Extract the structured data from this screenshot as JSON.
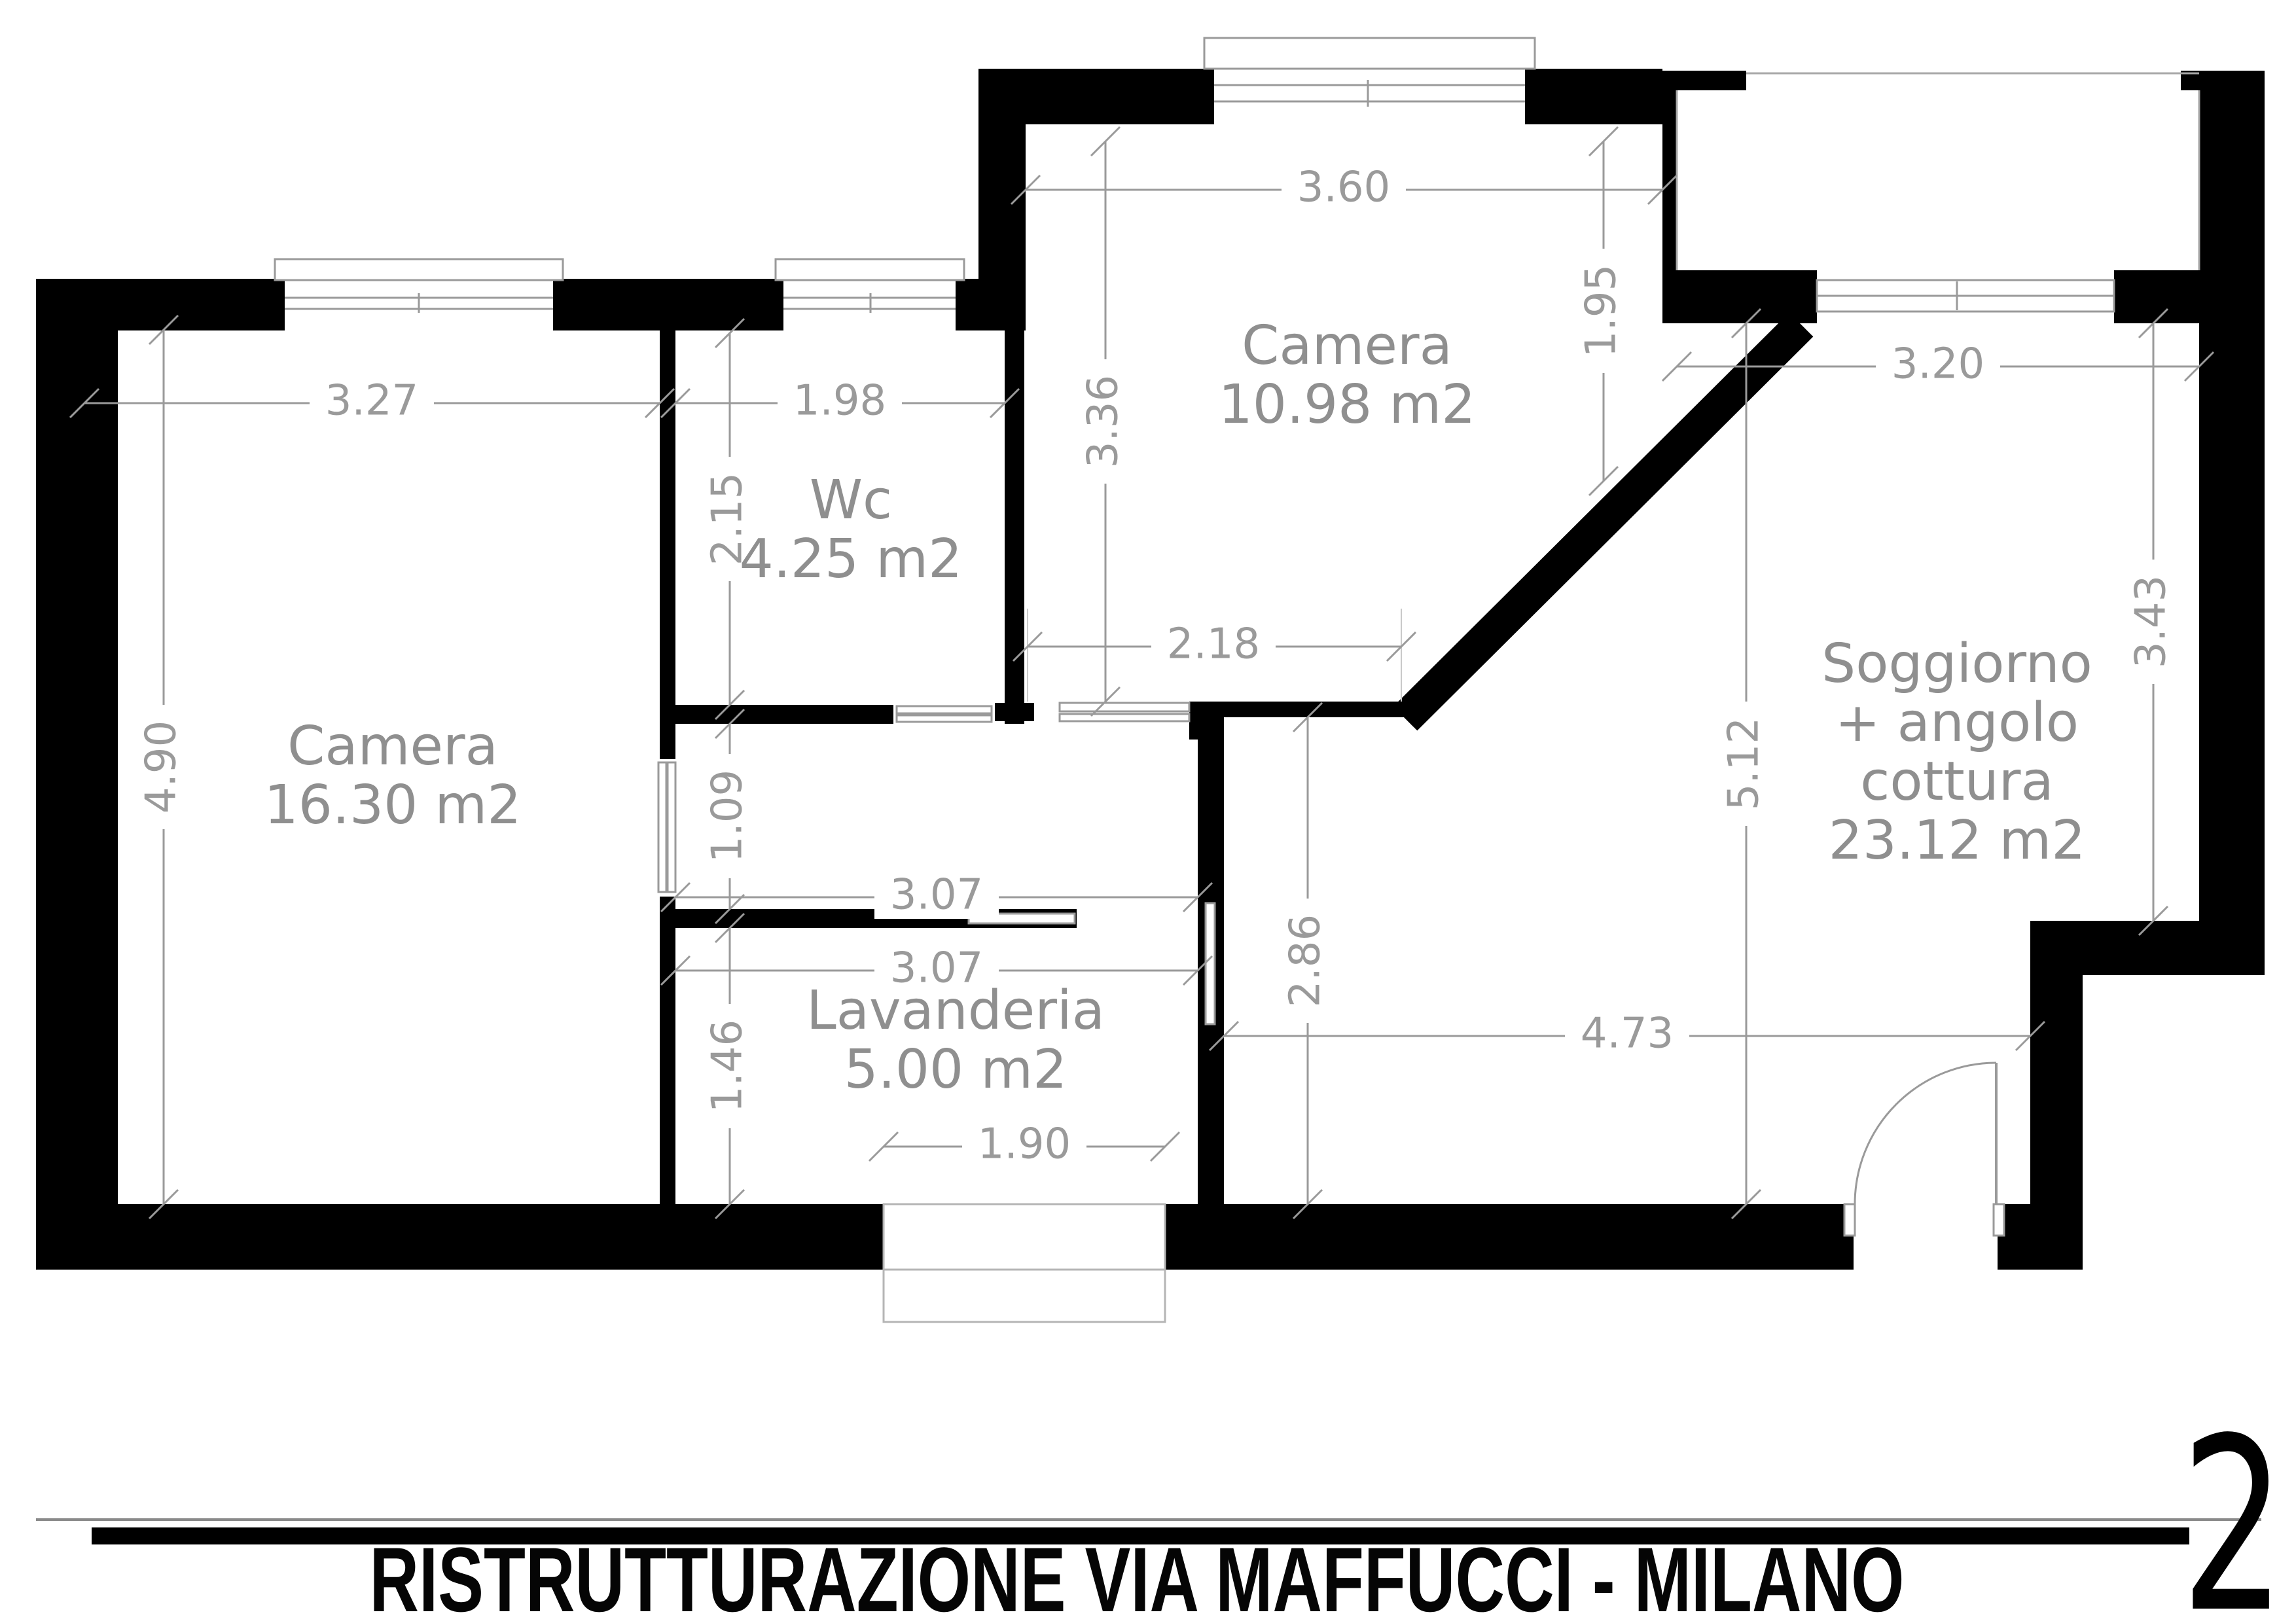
{
  "title_block": {
    "project_title": "RISTRUTTURAZIONE VIA MAFFUCCI - MILANO",
    "sheet_number": "2"
  },
  "floor_plan": {
    "rooms": [
      {
        "id": "camera-sx",
        "name": "Camera",
        "area": "16.30 m2"
      },
      {
        "id": "wc",
        "name": "Wc",
        "area": "4.25 m2"
      },
      {
        "id": "camera-top",
        "name": "Camera",
        "area": "10.98 m2"
      },
      {
        "id": "soggiorno",
        "name": "Soggiorno",
        "name_line2": "+ angolo",
        "name_line3": "cottura",
        "area": "23.12 m2"
      },
      {
        "id": "lavanderia",
        "name": "Lavanderia",
        "area": "5.00 m2"
      }
    ],
    "dimensions_m": {
      "camera_sx_width": "3.27",
      "camera_sx_height": "4.90",
      "wc_width": "1.98",
      "wc_height": "2.15",
      "camera_top_width": "3.60",
      "camera_top_height_left": "3.36",
      "camera_top_height_right": "1.95",
      "camera_top_lower_width": "2.18",
      "soggiorno_top_width": "3.20",
      "soggiorno_height_left": "5.12",
      "soggiorno_height_right": "3.43",
      "soggiorno_lower_width": "4.73",
      "soggiorno_passage_height": "2.86",
      "corridor_height": "1.09",
      "lavanderia_top_width": "3.07",
      "lavanderia_width": "3.07",
      "lavanderia_height": "1.46",
      "lavanderia_door_width": "1.90"
    },
    "colors": {
      "walls": "#000000",
      "dimension_lines": "#9a9a9a",
      "labels": "#8f8f8f"
    }
  }
}
